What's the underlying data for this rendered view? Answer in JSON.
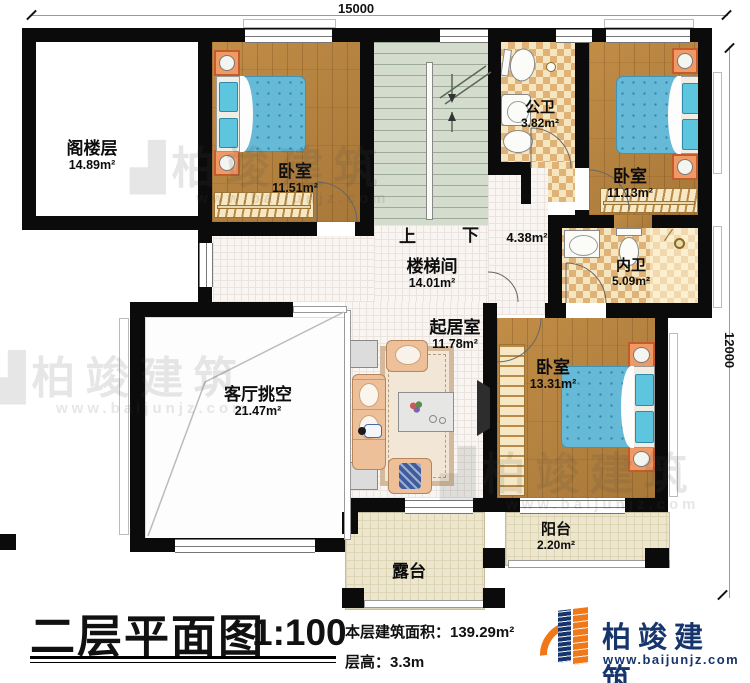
{
  "dimensions": {
    "top": "15000",
    "right": "12000"
  },
  "rooms": [
    {
      "name": "阁楼层",
      "area": "14.89m²"
    },
    {
      "name": "卧室",
      "area": "11.51m²"
    },
    {
      "name": "楼梯间",
      "area": "14.01m²"
    },
    {
      "name": "公卫",
      "area": "3.82m²"
    },
    {
      "name": "卧室",
      "area": "11.13m²"
    },
    {
      "name": "内卫",
      "area": "5.09m²"
    },
    {
      "name": "起居室",
      "area": "11.78m²"
    },
    {
      "name": "客厅挑空",
      "area": "21.47m²"
    },
    {
      "name": "卧室",
      "area": "13.31m²"
    },
    {
      "name": "阳台",
      "area": "2.20m²"
    },
    {
      "name": "露台",
      "area": ""
    },
    {
      "name": "",
      "area": "4.38m²"
    }
  ],
  "stairs": {
    "up": "上",
    "down": "下"
  },
  "titleblock": {
    "title": "二层平面图",
    "scale": "1:100",
    "floor_area": "本层建筑面积：139.29m²",
    "floor_height": "层高：3.3m"
  },
  "brand": {
    "name": "柏竣建筑",
    "url": "www.baijunjz.com"
  },
  "watermark": {
    "name": "柏竣建筑",
    "url": "www.baijunjz.com"
  }
}
